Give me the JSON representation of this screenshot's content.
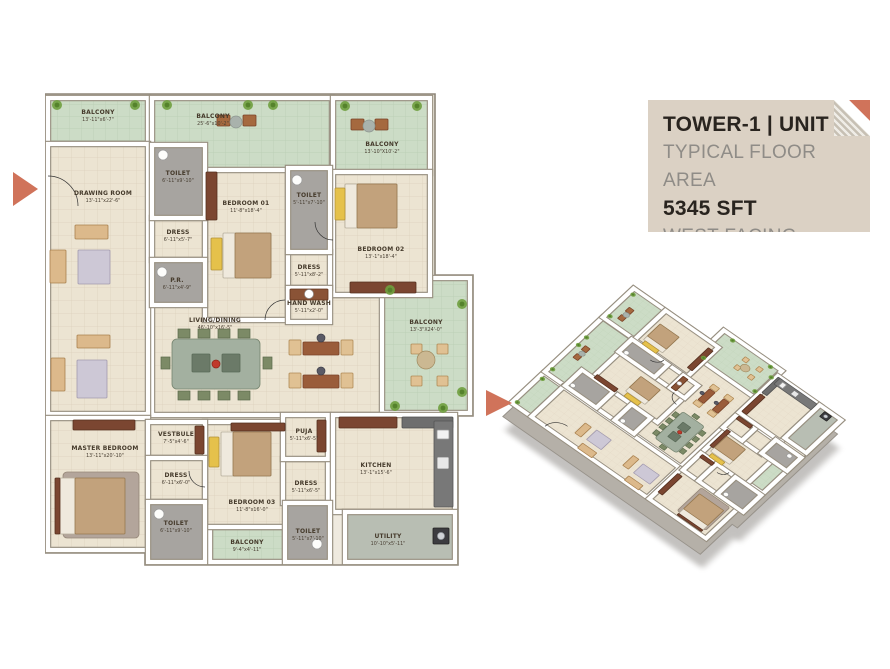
{
  "panel": {
    "title": "TOWER-1 | UNIT 1",
    "subtitle": "TYPICAL FLOOR AREA",
    "area": "5345 SFT",
    "facing": "WEST FACING"
  },
  "colors": {
    "accent_orange": "#d0735a",
    "panel_beige": "#dbd1c4",
    "floor_cream": "#ece4d2",
    "balcony_green": "#ccdcc6",
    "toilet_gray": "#a7a4a0"
  },
  "floorplan": {
    "rooms": [
      {
        "id": "living-dining",
        "name": "LIVING/DINING",
        "dims": "46'-10\"x16'-5\""
      },
      {
        "id": "balcony-1",
        "name": "BALCONY",
        "dims": "13'-11\"x6'-7\""
      },
      {
        "id": "balcony-2",
        "name": "BALCONY",
        "dims": "25'-6\"x10'-2\""
      },
      {
        "id": "balcony-3",
        "name": "BALCONY",
        "dims": "13'-10\"X10'-2\""
      },
      {
        "id": "balcony-4",
        "name": "BALCONY",
        "dims": "13'-3\"X24'-0\""
      },
      {
        "id": "balcony-5",
        "name": "BALCONY",
        "dims": "9'-4\"x4'-11\""
      },
      {
        "id": "drawing-room",
        "name": "DRAWING ROOM",
        "dims": "13'-11\"x22'-6\""
      },
      {
        "id": "master-bedroom",
        "name": "MASTER BEDROOM",
        "dims": "13'-11\"x20'-10\""
      },
      {
        "id": "bedroom-01",
        "name": "BEDROOM 01",
        "dims": "11'-8\"x18'-4\""
      },
      {
        "id": "bedroom-02",
        "name": "BEDROOM 02",
        "dims": "13'-1\"x18'-4\""
      },
      {
        "id": "bedroom-03",
        "name": "BEDROOM 03",
        "dims": "11'-8\"x16'-0\""
      },
      {
        "id": "vestbule",
        "name": "VESTBULE",
        "dims": "7'-5\"x4'-6\""
      },
      {
        "id": "dress-1",
        "name": "DRESS",
        "dims": "6'-11\"x5'-7\""
      },
      {
        "id": "dress-2",
        "name": "DRESS",
        "dims": "5'-11\"x8'-2\""
      },
      {
        "id": "dress-3",
        "name": "DRESS",
        "dims": "6'-11\"x6'-0\""
      },
      {
        "id": "dress-4",
        "name": "DRESS",
        "dims": "5'-11\"x6'-5\""
      },
      {
        "id": "puja",
        "name": "PUJA",
        "dims": "5'-11\"x6'-5\""
      },
      {
        "id": "kitchen",
        "name": "KITCHEN",
        "dims": "13'-1\"x15'-6\""
      },
      {
        "id": "hand-wash",
        "name": "HAND WASH",
        "dims": "5'-11\"x2'-0\""
      },
      {
        "id": "toilet-1",
        "name": "TOILET",
        "dims": "6'-11\"x9'-10\""
      },
      {
        "id": "toilet-2",
        "name": "TOILET",
        "dims": "5'-11\"x7'-10\""
      },
      {
        "id": "toilet-3",
        "name": "TOILET",
        "dims": "6'-11\"x9'-10\""
      },
      {
        "id": "toilet-4",
        "name": "TOILET",
        "dims": "5'-11\"x7'-10\""
      },
      {
        "id": "pr",
        "name": "P.R.",
        "dims": "6'-11\"x4'-9\""
      },
      {
        "id": "utility",
        "name": "UTILITY",
        "dims": "10'-10\"x5'-11\""
      }
    ]
  }
}
